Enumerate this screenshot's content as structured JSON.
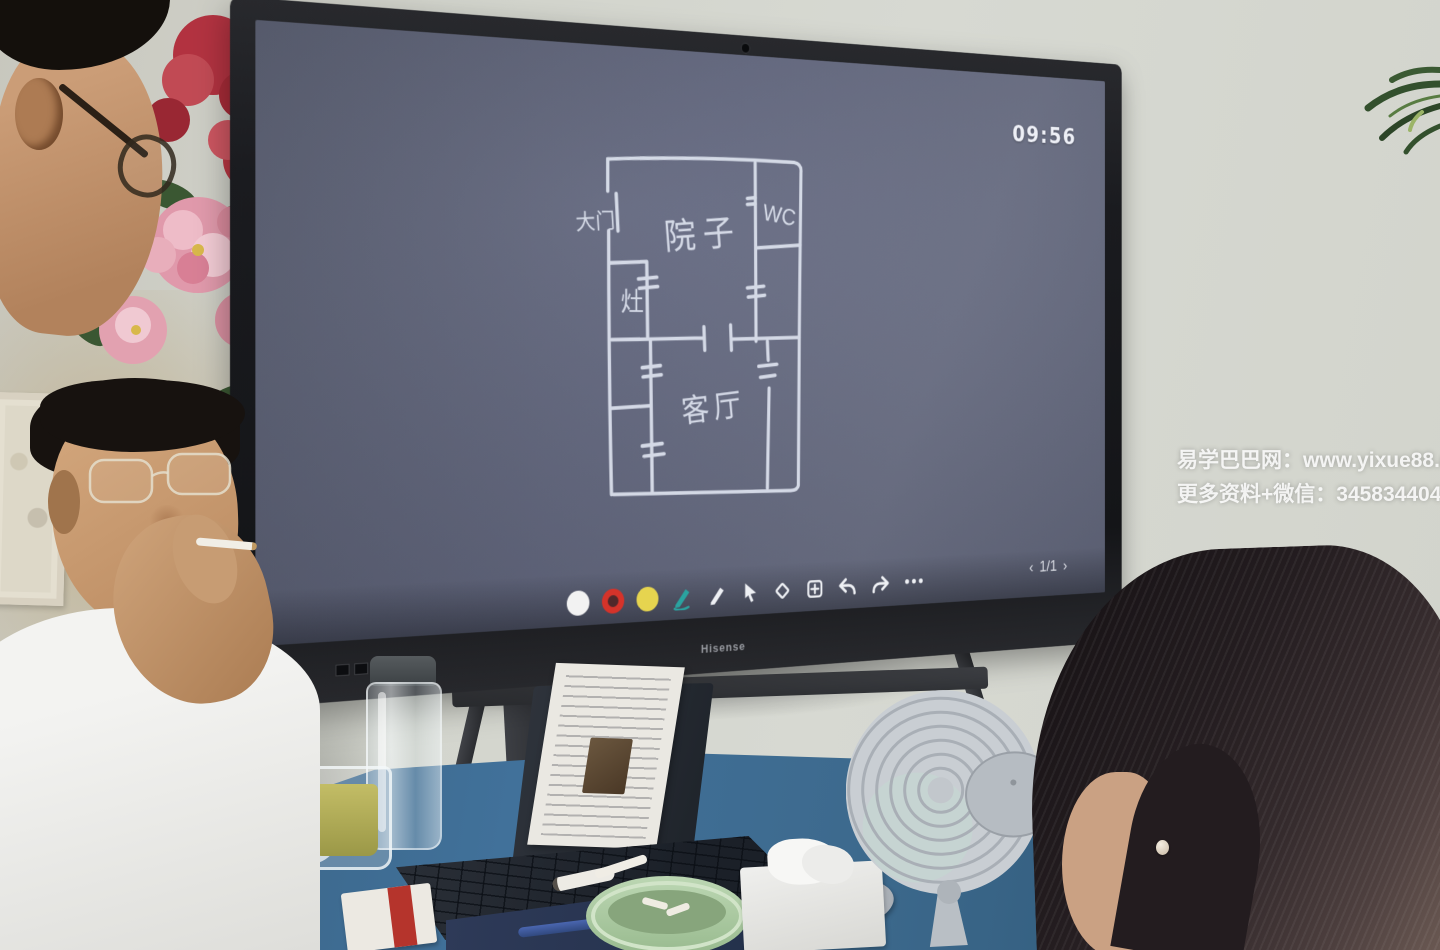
{
  "screen": {
    "brand": "Hisense",
    "clock": "09:56",
    "page_indicator": {
      "prev": "‹",
      "label": "1/1",
      "next": "›"
    },
    "toolbar": {
      "swatches": [
        {
          "name": "white-ink",
          "hex": "#f2f2f2"
        },
        {
          "name": "red-ink",
          "hex": "#d5332a"
        },
        {
          "name": "yellow-ink",
          "hex": "#e6d44f"
        }
      ],
      "tools": [
        "active-pen",
        "pen",
        "select-cursor",
        "eraser",
        "add-board",
        "undo",
        "redo",
        "more"
      ],
      "active_pen_color": "#2aa3a0"
    },
    "floorplan": {
      "labels": {
        "gate": "大门",
        "courtyard": "院子",
        "wc": "WC",
        "stove": "灶",
        "living_room": "客厅"
      },
      "ink": "#dde2ee",
      "canvas": "#666b80"
    }
  },
  "watermark": {
    "line1": "易学巴巴网：www.yixue88.cn",
    "line2": "更多资料+微信：3458344044"
  }
}
